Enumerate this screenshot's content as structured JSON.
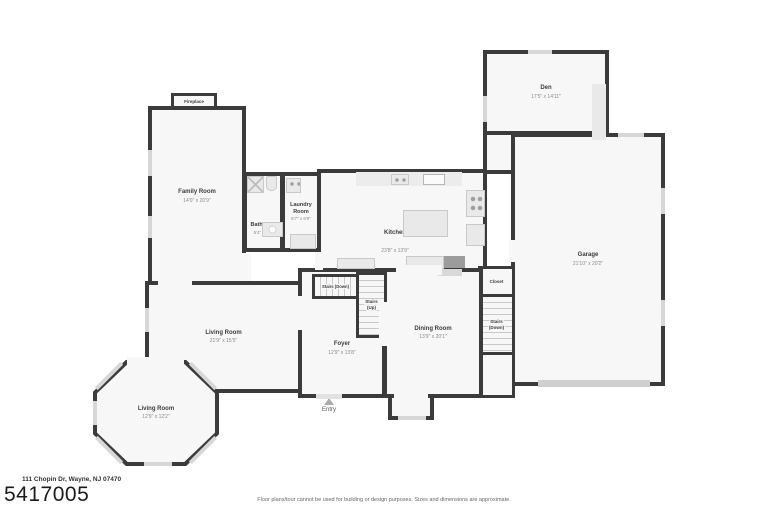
{
  "header": {
    "address": "111 Chopin Dr, Wayne, NJ 07470",
    "listing_number": "5417005"
  },
  "footer": {
    "disclaimer": "Floor plans/tour cannot be used for building or design purposes. Sizes and dimensions are approximate."
  },
  "entry": {
    "label": "Entry"
  },
  "rooms": {
    "fireplace": {
      "label": "Fireplace"
    },
    "family_room": {
      "label": "Family Room",
      "dims": "14'0\" x 20'9\""
    },
    "bathroom": {
      "label": "Bathroom",
      "dims": "5'4\" x 8'9\""
    },
    "laundry_room": {
      "label": "Laundry Room",
      "dims": "6'7\" x 6'9\""
    },
    "kitchen": {
      "label": "Kitchen",
      "dims": "23'8\" x 13'9\""
    },
    "den": {
      "label": "Den",
      "dims": "17'5\" x 14'11\""
    },
    "garage": {
      "label": "Garage",
      "dims": "21'10\" x 20'2\""
    },
    "closet": {
      "label": "Closet"
    },
    "stairs_garage": {
      "label": "Stairs",
      "sub": "(Down)"
    },
    "stairs_foyer": {
      "label": "Stairs (Down)"
    },
    "stairs_up": {
      "label": "Stairs",
      "sub": "(Up)"
    },
    "dining_room": {
      "label": "Dining Room",
      "dims": "13'9\" x 20'1\""
    },
    "foyer": {
      "label": "Foyer",
      "dims": "12'9\" x 13'8\""
    },
    "living_room": {
      "label": "Living Room",
      "dims": "21'9\" x 15'5\""
    },
    "living_room_bay": {
      "label": "Living Room",
      "dims": "12'9\" x 12'2\""
    }
  },
  "colors": {
    "wall": "#3b3b3b",
    "room_fill": "#f7f7f7",
    "fixture": "#e9e9e9",
    "window": "#d7d7d7",
    "stair_line": "#c9c9c9",
    "garage_door": "#cfcfcf"
  }
}
